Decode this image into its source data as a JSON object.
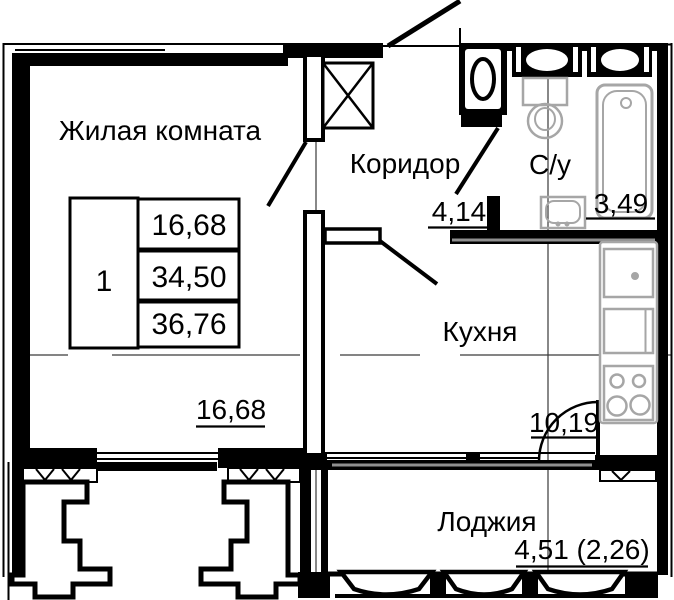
{
  "title": "План однокомнатной квартиры",
  "rooms": [
    {
      "name": "Жилая комната",
      "area": "16,68"
    },
    {
      "name": "Коридор",
      "area": "4,14"
    },
    {
      "name": "С/у",
      "area": "3,49"
    },
    {
      "name": "Кухня",
      "area": "10,19"
    },
    {
      "name": "Лоджия",
      "area": "4,51 (2,26)"
    }
  ],
  "summary_table": {
    "rooms_count": "1",
    "living_area": "16,68",
    "apartment_area": "34,50",
    "total_area": "36,76"
  },
  "colors": {
    "walls": "#000000",
    "fixtures": "#a6a6a6",
    "background": "#ffffff"
  }
}
